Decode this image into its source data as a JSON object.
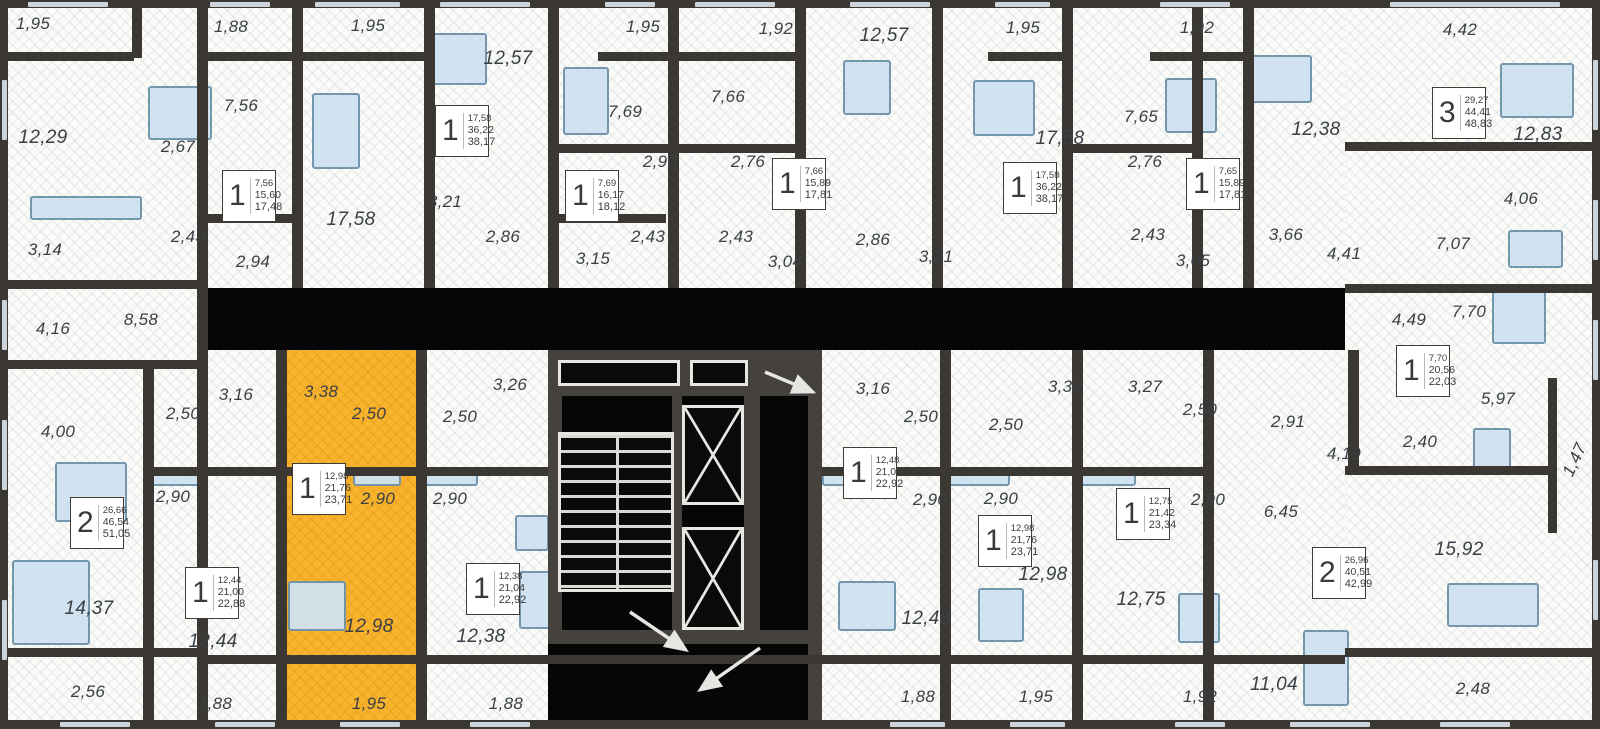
{
  "plan_title": "residential-floor-plan",
  "colors": {
    "wall_dark": "#3b3733",
    "void_black": "#060606",
    "floor_white": "#fbfbf8",
    "highlight_yellow": "#f8b42d",
    "furniture_blue": "#cfe2f0",
    "label_gray": "#3b4046"
  },
  "room_labels": [
    {
      "t": "1,95",
      "x": 33,
      "y": 24
    },
    {
      "t": "1,88",
      "x": 231,
      "y": 27
    },
    {
      "t": "1,95",
      "x": 368,
      "y": 26
    },
    {
      "t": "12,57",
      "x": 508,
      "y": 59
    },
    {
      "t": "1,95",
      "x": 643,
      "y": 27
    },
    {
      "t": "1,92",
      "x": 776,
      "y": 29
    },
    {
      "t": "12,57",
      "x": 884,
      "y": 36
    },
    {
      "t": "1,95",
      "x": 1023,
      "y": 28
    },
    {
      "t": "1,92",
      "x": 1197,
      "y": 28
    },
    {
      "t": "4,42",
      "x": 1460,
      "y": 30
    },
    {
      "t": "12,29",
      "x": 43,
      "y": 138
    },
    {
      "t": "7,56",
      "x": 241,
      "y": 106
    },
    {
      "t": "2,67",
      "x": 178,
      "y": 147
    },
    {
      "t": "7,69",
      "x": 625,
      "y": 112
    },
    {
      "t": "7,66",
      "x": 728,
      "y": 97
    },
    {
      "t": "7,65",
      "x": 1141,
      "y": 117
    },
    {
      "t": "17,58",
      "x": 351,
      "y": 220
    },
    {
      "t": "17,58",
      "x": 1060,
      "y": 139
    },
    {
      "t": "12,38",
      "x": 1316,
      "y": 130
    },
    {
      "t": "12,83",
      "x": 1538,
      "y": 135
    },
    {
      "t": "2,90",
      "x": 660,
      "y": 162
    },
    {
      "t": "2,76",
      "x": 748,
      "y": 162
    },
    {
      "t": "2,76",
      "x": 1145,
      "y": 162
    },
    {
      "t": "3,14",
      "x": 45,
      "y": 250
    },
    {
      "t": "2,43",
      "x": 188,
      "y": 237
    },
    {
      "t": "2,94",
      "x": 253,
      "y": 262
    },
    {
      "t": "3,21",
      "x": 445,
      "y": 202
    },
    {
      "t": "2,86",
      "x": 503,
      "y": 237
    },
    {
      "t": "3,15",
      "x": 593,
      "y": 259
    },
    {
      "t": "2,43",
      "x": 648,
      "y": 237
    },
    {
      "t": "2,43",
      "x": 736,
      "y": 237
    },
    {
      "t": "3,04",
      "x": 785,
      "y": 262
    },
    {
      "t": "2,86",
      "x": 873,
      "y": 240
    },
    {
      "t": "3,21",
      "x": 936,
      "y": 257
    },
    {
      "t": "2,43",
      "x": 1148,
      "y": 235
    },
    {
      "t": "3,05",
      "x": 1193,
      "y": 261
    },
    {
      "t": "3,66",
      "x": 1286,
      "y": 235
    },
    {
      "t": "4,41",
      "x": 1344,
      "y": 254
    },
    {
      "t": "4,06",
      "x": 1521,
      "y": 199
    },
    {
      "t": "7,07",
      "x": 1453,
      "y": 244
    },
    {
      "t": "4,16",
      "x": 53,
      "y": 329
    },
    {
      "t": "8,58",
      "x": 141,
      "y": 320
    },
    {
      "t": "4,49",
      "x": 1409,
      "y": 320
    },
    {
      "t": "7,70",
      "x": 1469,
      "y": 312
    },
    {
      "t": "5,97",
      "x": 1498,
      "y": 399
    },
    {
      "t": "2,40",
      "x": 1420,
      "y": 442
    },
    {
      "t": "1,47",
      "x": 1575,
      "y": 460,
      "r": -65
    },
    {
      "t": "4,00",
      "x": 58,
      "y": 432
    },
    {
      "t": "2,50",
      "x": 183,
      "y": 414
    },
    {
      "t": "3,16",
      "x": 236,
      "y": 395
    },
    {
      "t": "2,90",
      "x": 173,
      "y": 497
    },
    {
      "t": "14,37",
      "x": 89,
      "y": 609
    },
    {
      "t": "2,56",
      "x": 88,
      "y": 692
    },
    {
      "t": "12,44",
      "x": 213,
      "y": 642
    },
    {
      "t": "1,88",
      "x": 215,
      "y": 704
    },
    {
      "t": "3,38",
      "x": 321,
      "y": 392
    },
    {
      "t": "2,50",
      "x": 369,
      "y": 414
    },
    {
      "t": "2,90",
      "x": 378,
      "y": 499
    },
    {
      "t": "12,98",
      "x": 369,
      "y": 627
    },
    {
      "t": "1,95",
      "x": 369,
      "y": 704
    },
    {
      "t": "3,26",
      "x": 510,
      "y": 385
    },
    {
      "t": "2,50",
      "x": 460,
      "y": 417
    },
    {
      "t": "2,90",
      "x": 450,
      "y": 499
    },
    {
      "t": "12,38",
      "x": 481,
      "y": 637
    },
    {
      "t": "1,88",
      "x": 506,
      "y": 704
    },
    {
      "t": "3,16",
      "x": 873,
      "y": 389
    },
    {
      "t": "2,50",
      "x": 921,
      "y": 417
    },
    {
      "t": "2,90",
      "x": 930,
      "y": 500
    },
    {
      "t": "12,48",
      "x": 926,
      "y": 619
    },
    {
      "t": "1,88",
      "x": 918,
      "y": 697
    },
    {
      "t": "3,38",
      "x": 1065,
      "y": 387
    },
    {
      "t": "2,50",
      "x": 1006,
      "y": 425
    },
    {
      "t": "2,90",
      "x": 1001,
      "y": 499
    },
    {
      "t": "12,98",
      "x": 1043,
      "y": 575
    },
    {
      "t": "1,95",
      "x": 1036,
      "y": 697
    },
    {
      "t": "3,27",
      "x": 1145,
      "y": 387
    },
    {
      "t": "2,50",
      "x": 1200,
      "y": 410
    },
    {
      "t": "2,90",
      "x": 1208,
      "y": 500
    },
    {
      "t": "12,75",
      "x": 1141,
      "y": 600
    },
    {
      "t": "1,92",
      "x": 1200,
      "y": 697
    },
    {
      "t": "2,91",
      "x": 1288,
      "y": 422
    },
    {
      "t": "4,19",
      "x": 1344,
      "y": 454
    },
    {
      "t": "6,45",
      "x": 1281,
      "y": 512
    },
    {
      "t": "15,92",
      "x": 1459,
      "y": 550
    },
    {
      "t": "11,04",
      "x": 1274,
      "y": 685
    },
    {
      "t": "2,48",
      "x": 1473,
      "y": 689
    }
  ],
  "unit_boxes": [
    {
      "type": "1",
      "areas": [
        "7,56",
        "15,60",
        "17,48"
      ],
      "x": 222,
      "y": 170,
      "highlighted": false
    },
    {
      "type": "1",
      "areas": [
        "17,58",
        "36,22",
        "38,17"
      ],
      "x": 435,
      "y": 105,
      "highlighted": false
    },
    {
      "type": "1",
      "areas": [
        "7,69",
        "16,17",
        "18,12"
      ],
      "x": 565,
      "y": 170,
      "highlighted": false
    },
    {
      "type": "1",
      "areas": [
        "7,66",
        "15,89",
        "17,81"
      ],
      "x": 772,
      "y": 158,
      "highlighted": false
    },
    {
      "type": "1",
      "areas": [
        "17,58",
        "36,22",
        "38,17"
      ],
      "x": 1003,
      "y": 162,
      "highlighted": false
    },
    {
      "type": "1",
      "areas": [
        "7,65",
        "15,89",
        "17,81"
      ],
      "x": 1186,
      "y": 158,
      "highlighted": false
    },
    {
      "type": "3",
      "areas": [
        "29,27",
        "44,41",
        "48,83"
      ],
      "x": 1432,
      "y": 87,
      "highlighted": false
    },
    {
      "type": "1",
      "areas": [
        "7,70",
        "20,56",
        "22,03"
      ],
      "x": 1396,
      "y": 345,
      "highlighted": false
    },
    {
      "type": "2",
      "areas": [
        "26,66",
        "46,54",
        "51,05"
      ],
      "x": 70,
      "y": 497,
      "highlighted": false
    },
    {
      "type": "1",
      "areas": [
        "12,44",
        "21,00",
        "22,88"
      ],
      "x": 185,
      "y": 567,
      "highlighted": false
    },
    {
      "type": "1",
      "areas": [
        "12,98",
        "21,76",
        "23,71"
      ],
      "x": 292,
      "y": 463,
      "highlighted": true
    },
    {
      "type": "1",
      "areas": [
        "12,38",
        "21,04",
        "22,92"
      ],
      "x": 466,
      "y": 563,
      "highlighted": false
    },
    {
      "type": "1",
      "areas": [
        "12,48",
        "21,04",
        "22,92"
      ],
      "x": 843,
      "y": 447,
      "highlighted": false
    },
    {
      "type": "1",
      "areas": [
        "12,98",
        "21,76",
        "23,71"
      ],
      "x": 978,
      "y": 515,
      "highlighted": false
    },
    {
      "type": "1",
      "areas": [
        "12,75",
        "21,42",
        "23,34"
      ],
      "x": 1116,
      "y": 488,
      "highlighted": false
    },
    {
      "type": "2",
      "areas": [
        "26,96",
        "40,51",
        "42,99"
      ],
      "x": 1312,
      "y": 547,
      "highlighted": false
    }
  ]
}
